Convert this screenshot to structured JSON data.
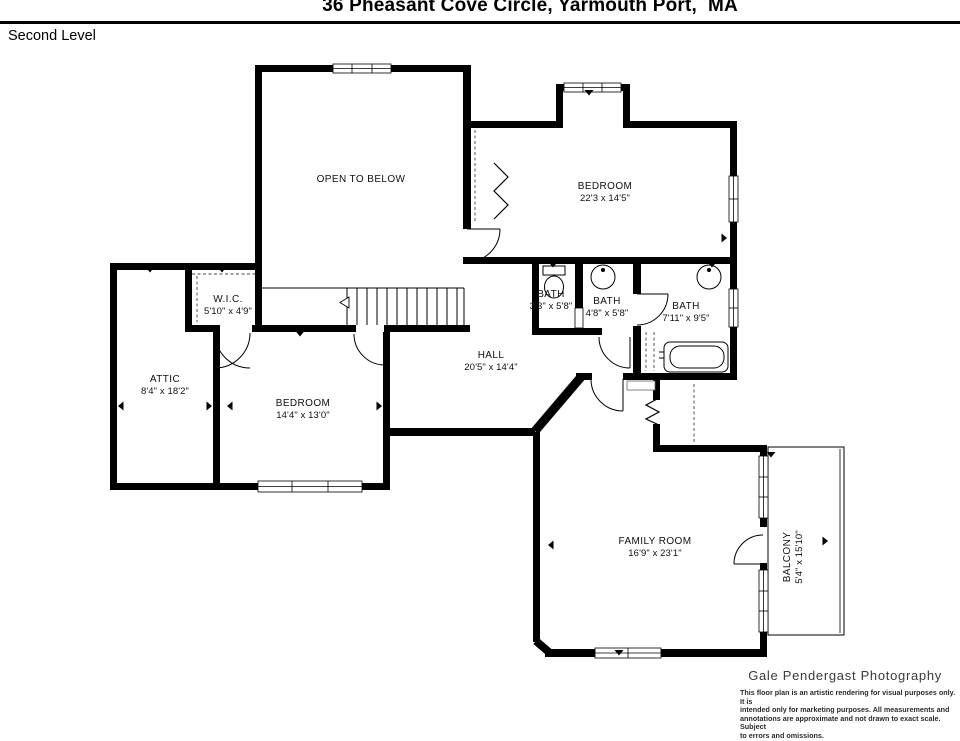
{
  "header": {
    "title": "36 Pheasant Cove Circle, Yarmouth Port,  MA",
    "level_label": "Second Level"
  },
  "rooms": {
    "open_to_below": {
      "name": "OPEN TO BELOW",
      "dims": ""
    },
    "bedroom_primary": {
      "name": "BEDROOM",
      "dims": "22'3 x 14'5\""
    },
    "wic": {
      "name": "W.I.C.",
      "dims": "5'10\" x 4'9\""
    },
    "bath_small": {
      "name": "BATH",
      "dims": "3'3\" x 5'8\""
    },
    "bath_mid": {
      "name": "BATH",
      "dims": "4'8\" x 5'8\""
    },
    "bath_large": {
      "name": "BATH",
      "dims": "7'11\" x 9'5\""
    },
    "attic": {
      "name": "ATTIC",
      "dims": "8'4\" x 18'2\""
    },
    "bedroom_second": {
      "name": "BEDROOM",
      "dims": "14'4\" x 13'0\""
    },
    "hall": {
      "name": "HALL",
      "dims": "20'5\" x 14'4\""
    },
    "family_room": {
      "name": "FAMILY ROOM",
      "dims": "16'9\" x 23'1\""
    },
    "balcony": {
      "name": "BALCONY",
      "dims": "5'4\" x 15'10\""
    }
  },
  "footer": {
    "studio": "Gale Pendergast Photography",
    "disclaimer_lines": [
      "This floor plan is an artistic rendering for visual purposes only. It is",
      "intended only for marketing purposes. All measurements and",
      "annotations are approximate and not drawn to exact scale. Subject",
      "to errors and omissions."
    ]
  },
  "colors": {
    "wall": "#000000",
    "background": "#ffffff",
    "text": "#101010"
  }
}
